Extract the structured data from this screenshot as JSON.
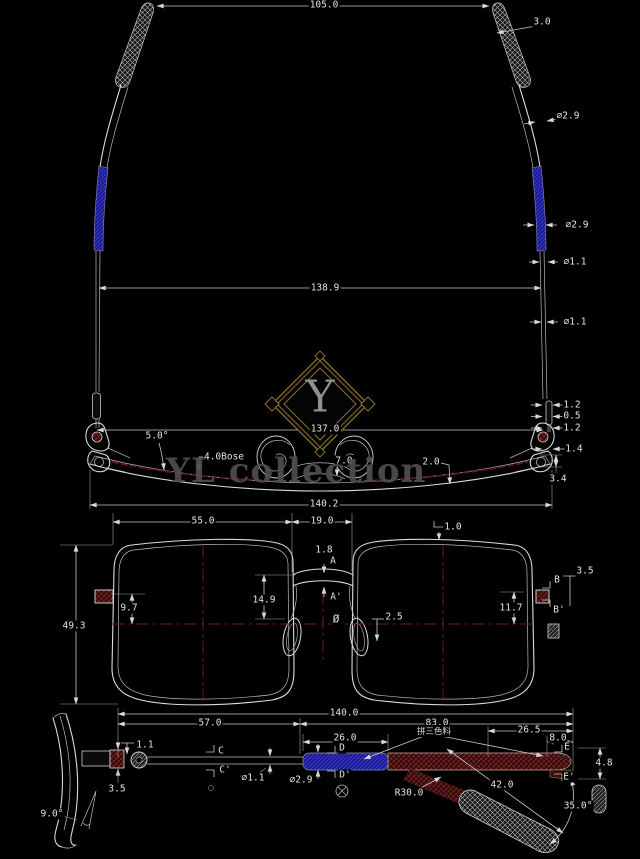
{
  "colors": {
    "background": "#000000",
    "line": "#dcdcdc",
    "dimension_line": "#c8c8c8",
    "centerline_red": "#6e1a1a",
    "accent_blue": "#1d1d9a",
    "accent_red": "#471111",
    "logo_gold": "#8d6f2b",
    "watermark_gray": "#4f4f4f"
  },
  "watermark": {
    "monogram": "Y",
    "brand": "YL collection"
  },
  "top_view": {
    "temple_tip_span": "105.0",
    "tip_width": "3.0",
    "temple_dia_upper": "⌀2.9",
    "temple_dia_sleeve": "⌀2.9",
    "wire_dia_upper": "⌀1.1",
    "open_temple_span": "138.9",
    "wire_dia_lower": "⌀1.1",
    "endpiece_step_1": "1.2",
    "endpiece_step_2": "0.5",
    "endpiece_step_3": "1.2",
    "hinge_span": "137.0",
    "endpiece_width": "1.4",
    "flare_angle": "5.0°",
    "base_curve": "4.0Bose",
    "bridge_gap": "7.0",
    "rim_wire": "2.0",
    "frame_height": "3.4",
    "overall_width": "140.2"
  },
  "front_view": {
    "lens_width": "55.0",
    "bridge_width": "19.0",
    "rim_thickness": "1.0",
    "bridge_thickness": "1.8",
    "section_a": "A",
    "section_a_prime": "A'",
    "bridge_drop": "14.9",
    "hinge_height_pos": "9.7",
    "lens_height": "49.3",
    "diameter_symbol": "Ø",
    "pad_gap": "2.5",
    "endpiece_drop": "11.7",
    "endpiece_size": "3.5",
    "section_b": "B",
    "section_b_prime": "B'"
  },
  "side_view": {
    "overall_length": "140.0",
    "front_to_hinge": "57.0",
    "temple_length": "83.0",
    "tip_section": "26.5",
    "end_cap": "8.0",
    "material_note": "拼三色料",
    "hinge_gap": "1.1",
    "section_c": "C",
    "section_c_prime": "C'",
    "sleeve_length": "26.0",
    "section_d": "D",
    "section_d_prime": "D'",
    "section_e": "E",
    "section_e_prime": "E'",
    "end_height": "4.8",
    "wire_dia": "⌀1.1",
    "sleeve_dia": "⌀2.9",
    "bend_radius": "R30.0",
    "drop_length": "42.0",
    "drop_angle": "35.0°",
    "hinge_height": "3.5",
    "pantoscopic_tilt": "9.0°"
  }
}
